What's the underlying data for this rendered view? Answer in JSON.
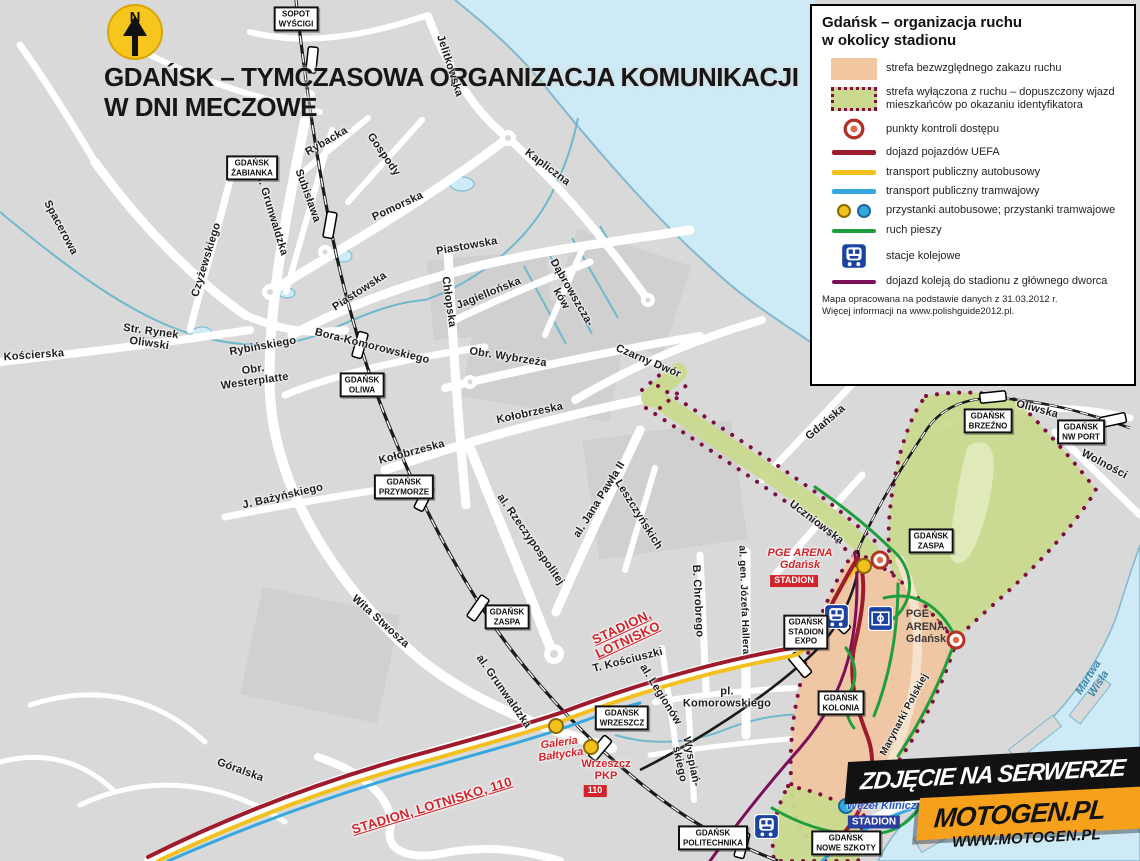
{
  "title": {
    "text": "GDAŃSK – TYMCZASOWA ORGANIZACJA KOMUNIKACJI\nW DNI MECZOWE"
  },
  "north_label": "N",
  "legend": {
    "title": "Gdańsk – organizacja ruchu\nw okolicy stadionu",
    "items": [
      {
        "key": "zone-forbidden",
        "label": "strefa bezwzględnego zakazu ruchu"
      },
      {
        "key": "zone-residents",
        "label": "strefa wyłączona z ruchu – dopuszczony wjazd mieszkańców po okazaniu identyfikatora"
      },
      {
        "key": "control-points",
        "label": "punkty kontroli dostępu"
      },
      {
        "key": "uefa-route",
        "label": "dojazd pojazdów UEFA"
      },
      {
        "key": "bus-transit",
        "label": "transport publiczny autobusowy"
      },
      {
        "key": "tram-transit",
        "label": "transport publiczny tramwajowy"
      },
      {
        "key": "stops",
        "label": "przystanki autobusowe; przystanki tramwajowe"
      },
      {
        "key": "pedestrian",
        "label": "ruch pieszy"
      },
      {
        "key": "rail-stations",
        "label": "stacje kolejowe"
      },
      {
        "key": "rail-access",
        "label": "dojazd koleją do stadionu z głównego dworca"
      }
    ],
    "footer": "Mapa opracowana na podstawie danych z 31.03.2012 r.\nWięcej informacji na www.polishguide2012.pl."
  },
  "stations": [
    "SOPOT\nWYŚCIGI",
    "GDAŃSK\nŻABIANKA",
    "GDAŃSK\nOLIWA",
    "GDAŃSK\nPRZYMORZE",
    "GDAŃSK\nZASPA",
    "GDAŃSK\nWRZESZCZ",
    "GDAŃSK\nSTADION\nEXPO",
    "GDAŃSK\nKOLONIA",
    "GDAŃSK\nBRZEŹNO",
    "GDAŃSK\nNW PORT",
    "GDAŃSK\nZASPA",
    "GDAŃSK\nPOLITECHNIKA",
    "GDAŃSK\nNOWE SZKOTY"
  ],
  "streets": [
    "Spacerowa",
    "Kościerska",
    "Str. Rynek\nOliwski",
    "Czyżewskiego",
    "al. Grunwaldzka",
    "Subisława",
    "Rybacka",
    "Gospody",
    "Pomorska",
    "Jelitkowska",
    "Kapliczna",
    "Piastowska",
    "Piastowska",
    "Chłopska",
    "Jagiellońska",
    "Dąbrowszcza-\nków",
    "Rybińskiego",
    "Obr.\nWesterplatte",
    "Bora-Komorowskiego",
    "Obr. Wybrzeża",
    "Kołobrzeska",
    "Kołobrzeska",
    "J. Bażyńskiego",
    "al. Rzeczypospolitej",
    "al. Jana Pawła II",
    "Leszczyńskich",
    "B. Chrobrego",
    "al. gen. Józefa Hallera",
    "Wita Stwosza",
    "al. Grunwaldzka",
    "T. Kościuszki",
    "al. Legionów",
    "pl.\nKomorowskiego",
    "Wyspiań-\nskiego",
    "Góralska",
    "Czarny Dwór",
    "Gdańska",
    "Uczniowska",
    "Oliwska",
    "Wolności",
    "Marynarki Polskiej"
  ],
  "water_labels": [
    "Martwa Wisła",
    "Kan. K."
  ],
  "highlights": {
    "stadion_lotnisko": "STADION,\nLOTNISKO",
    "stadion_lotnisko_110": "STADION, LOTNISKO, 110",
    "galeria_baltycka": "Galeria\nBałtycka",
    "wrzeszcz_pkp": "Wrzeszcz\nPKP",
    "badge_110": "110",
    "pge_arena_red": "PGE ARENA\nGdańsk",
    "stadion_red": "STADION",
    "pge_arena_dark": "PGE\nARENA\nGdańsk",
    "wezel_kliniczna": "Węzeł Kliniczna",
    "stadion_blue": "STADION"
  },
  "watermark": {
    "banner": "ZDJĘCIE NA SERWERZE",
    "brand": "MOTOGEN.PL",
    "url": "WWW.MOTOGEN.PL"
  },
  "icons": [
    "north-arrow",
    "train-station-icon",
    "stadium-icon",
    "control-point-icon",
    "bus-stop-icon",
    "tram-stop-icon"
  ],
  "colors": {
    "land": "#d9d9d9",
    "water": "#cdeaf6",
    "zone_forbidden_orange": "#f2c6a0",
    "zone_residents_green": "#cada8e",
    "zone_border_purple": "#7c1040",
    "uefa_red": "#9e1b2e",
    "bus_yellow": "#f2c11d",
    "tram_blue": "#35a8e0",
    "pedestrian_green": "#1f9e3d",
    "rail_access_purple": "#7c0f5a",
    "label_red": "#d2222a",
    "station_blue": "#1c43a0"
  }
}
